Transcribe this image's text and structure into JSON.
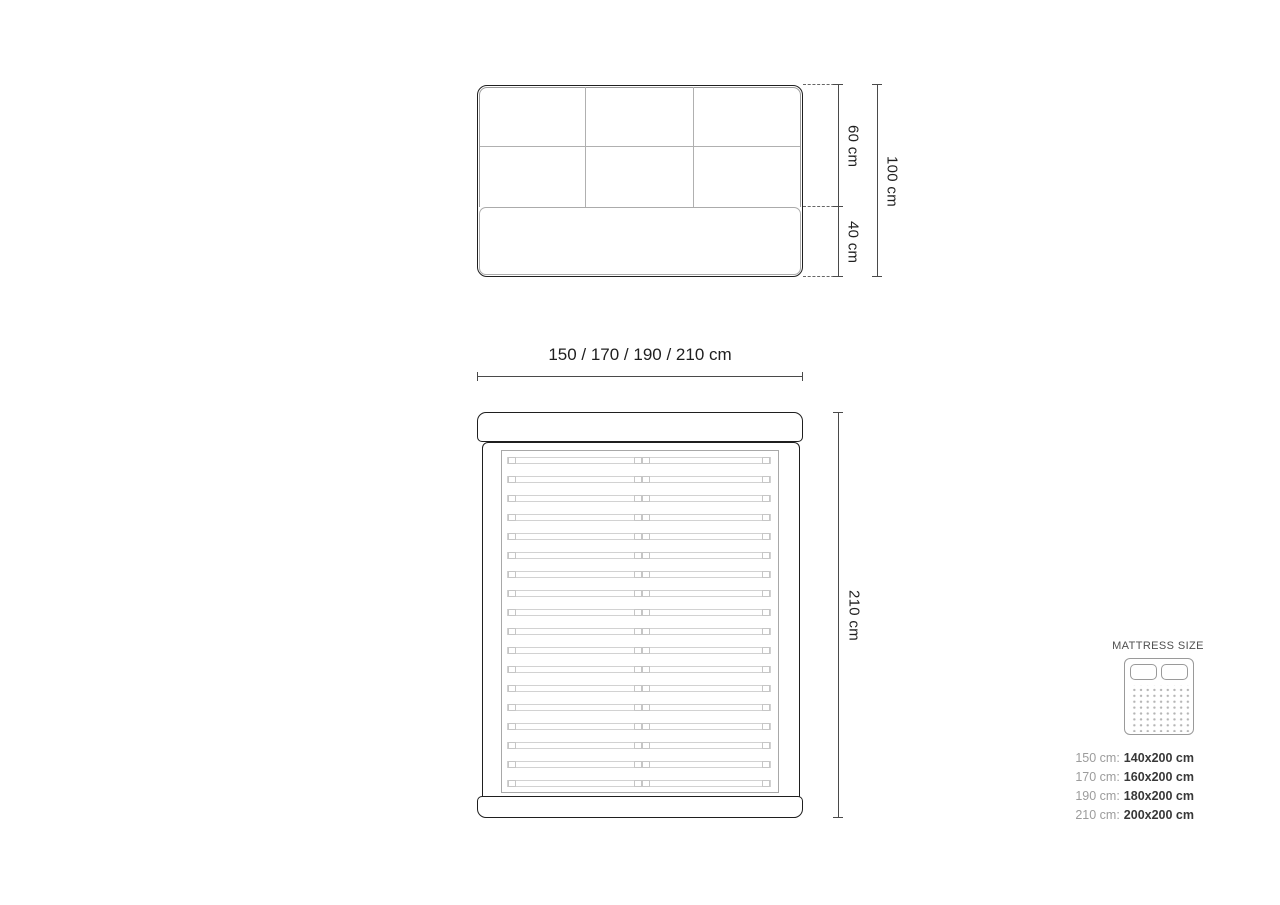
{
  "headboard_view": {
    "dim_60": "60 cm",
    "dim_40": "40 cm",
    "dim_100": "100 cm"
  },
  "width_dimension_label": "150 / 170 / 190 / 210 cm",
  "bed_view": {
    "dim_210": "210 cm",
    "slat_count": 18
  },
  "legend": {
    "title": "MATTRESS SIZE",
    "icon": "mattress-top-view-icon",
    "rows": [
      {
        "label": "150 cm:",
        "value": "140x200 cm"
      },
      {
        "label": "170 cm:",
        "value": "160x200 cm"
      },
      {
        "label": "190 cm:",
        "value": "180x200 cm"
      },
      {
        "label": "210 cm:",
        "value": "200x200 cm"
      }
    ]
  },
  "colors": {
    "outline_dark": "#1f1f1f",
    "inner_gray": "#a8a8a8",
    "slat_gray": "#d2d2d2",
    "dimension_line": "#4a4a4a",
    "legend_label_gray": "#9c9c9c",
    "legend_value_dark": "#383838",
    "background": "#ffffff"
  }
}
